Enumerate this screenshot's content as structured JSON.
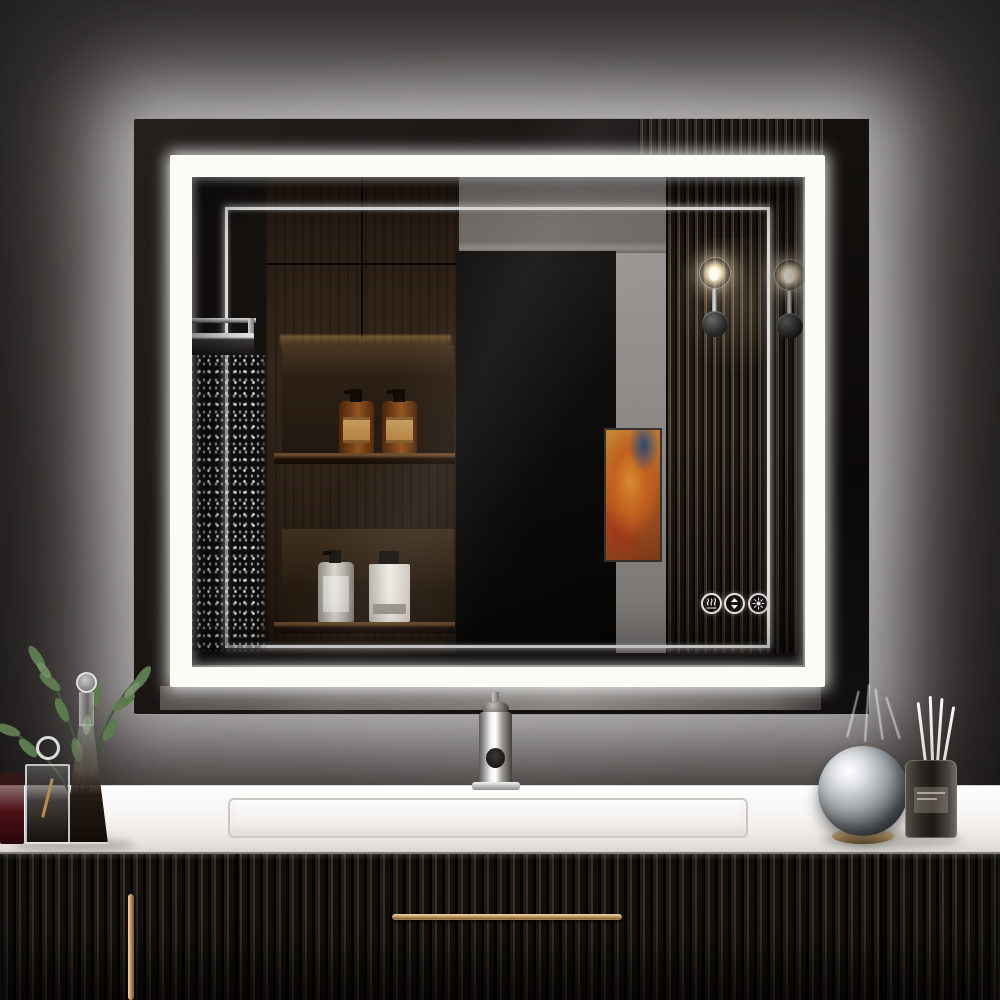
{
  "meta": {
    "kind": "product-photo",
    "subject": "Front-lit and backlit LED rectangular bathroom mirror mounted above a black fluted floating vanity",
    "visible_text": "none"
  },
  "palette": {
    "wall": "#3a3633",
    "led_white": "#fcfcf7",
    "halo": "#ffffff",
    "reflection_wood": "#33261b",
    "fluted_panel": "#453a30",
    "counter": "#f4f2ef",
    "vanity_black": "#17130f",
    "brass_handle": "#c59a63",
    "amber_bottle": "#7e441a",
    "artwork_orange": "#c2611f",
    "plant_green": "#5d7a4e",
    "sconce_glow": "#f6dd9b"
  },
  "mirror": {
    "style": "rectangular, double white LED frame (outer backlight halo, inner front-lit band plus thin accent line)",
    "controls": [
      {
        "id": "defog",
        "label": "Anti-fog",
        "icon": "defog-icon"
      },
      {
        "id": "dimmer",
        "label": "Brightness up/down",
        "icon": "dimmer-arrows-icon"
      },
      {
        "id": "color_temp",
        "label": "Color temperature",
        "icon": "color-temp-icon"
      }
    ],
    "reflection_items": [
      "rain shower head with running water",
      "dark walnut wall cabinets",
      "two amber pump bottles on lit shelf",
      "white pump bottle and white square bottle on lower shelf",
      "black wall panel",
      "gray wall with crown molding",
      "abstract orange-red artwork",
      "fluted wood slat accent wall",
      "two glowing glass-globe wall sconces"
    ]
  },
  "counter": {
    "material": "white stone top with integrated rectangular sink",
    "items_left": [
      "green eucalyptus sprigs",
      "red glass",
      "glass cube vase with dark liquid",
      "tall conical glass decanter with dark liquid and ball stopper"
    ],
    "items_center": [
      "polished chrome single-hole faucet"
    ],
    "items_right": [
      "mirrored silver sphere on brass ring base",
      "dark glass reed diffuser with four white reeds"
    ]
  },
  "vanity": {
    "finish": "black fluted / reeded front",
    "hardware": [
      "long horizontal brass bar pull on center drawer",
      "vertical brass bar pull on left door"
    ]
  }
}
